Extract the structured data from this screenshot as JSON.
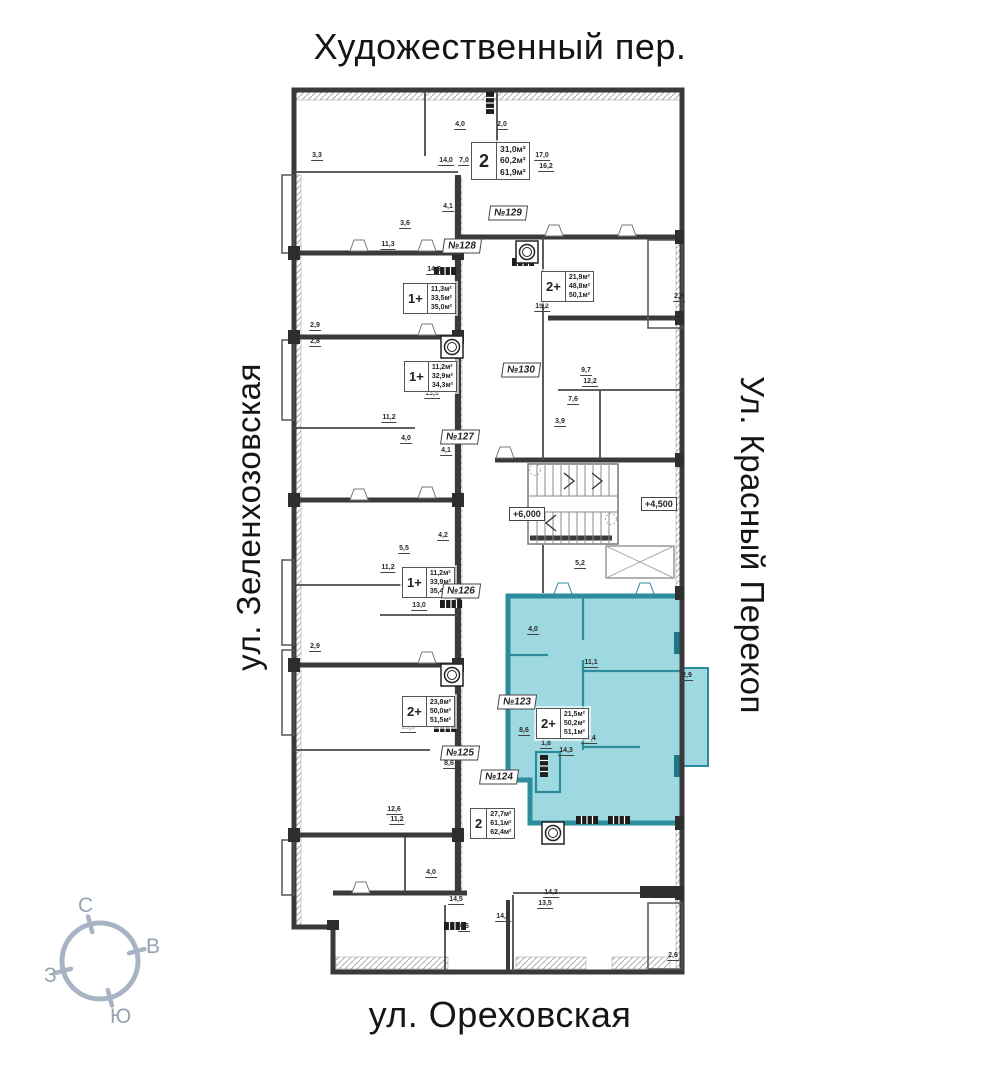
{
  "streets": {
    "top": "Художественный пер.",
    "left": "ул. Зеленхозовская",
    "right": "Ул. Красный Перекоп",
    "bottom": "ул. Ореховская"
  },
  "compass": {
    "north": "С",
    "east": "В",
    "west": "З",
    "south": "Ю"
  },
  "colors": {
    "highlight_fill": "#9ed8e1",
    "highlight_wall": "#2c8c9c",
    "wall": "#3a3a3a",
    "compass": "#a8b4c4"
  },
  "elevations": [
    {
      "label": "+6,000",
      "x": 509,
      "y": 507
    },
    {
      "label": "+4,500",
      "x": 641,
      "y": 497
    }
  ],
  "apartments": [
    {
      "number": "№129",
      "type": "2",
      "areas": [
        "31,0м²",
        "60,2м²",
        "61,9м²"
      ],
      "box": {
        "x": 471,
        "y": 142
      },
      "tag": {
        "x": 508,
        "y": 213
      },
      "large": true,
      "highlighted": false
    },
    {
      "number": "№128",
      "type": "1+",
      "areas": [
        "11,3м²",
        "33,5м²",
        "35,0м²"
      ],
      "box": {
        "x": 403,
        "y": 283
      },
      "tag": {
        "x": 462,
        "y": 246
      },
      "large": false,
      "highlighted": false
    },
    {
      "number": "№130",
      "type": "2+",
      "areas": [
        "21,9м²",
        "48,8м²",
        "50,1м²"
      ],
      "box": {
        "x": 541,
        "y": 271
      },
      "tag": {
        "x": 521,
        "y": 370
      },
      "large": false,
      "highlighted": false
    },
    {
      "number": "№127",
      "type": "1+",
      "areas": [
        "11,2м²",
        "32,9м²",
        "34,3м²"
      ],
      "box": {
        "x": 404,
        "y": 361
      },
      "tag": {
        "x": 460,
        "y": 437
      },
      "large": false,
      "highlighted": false
    },
    {
      "number": "№126",
      "type": "1+",
      "areas": [
        "11,2м²",
        "33,9м²",
        "35,4м²"
      ],
      "box": {
        "x": 402,
        "y": 567
      },
      "tag": {
        "x": 461,
        "y": 591
      },
      "large": false,
      "highlighted": false
    },
    {
      "number": "№125",
      "type": "2+",
      "areas": [
        "23,8м²",
        "50,0м²",
        "51,5м²"
      ],
      "box": {
        "x": 402,
        "y": 696
      },
      "tag": {
        "x": 460,
        "y": 753
      },
      "large": false,
      "highlighted": false
    },
    {
      "number": "№123",
      "type": "2+",
      "areas": [
        "21,5м²",
        "50,2м²",
        "51,1м²"
      ],
      "box": {
        "x": 536,
        "y": 708
      },
      "tag": {
        "x": 517,
        "y": 702
      },
      "large": false,
      "highlighted": true
    },
    {
      "number": "№124",
      "type": "2",
      "areas": [
        "27,7м²",
        "61,1м²",
        "62,4м²"
      ],
      "box": {
        "x": 470,
        "y": 808
      },
      "tag": {
        "x": 499,
        "y": 777
      },
      "large": false,
      "highlighted": false
    }
  ],
  "dimensions": [
    {
      "t": "3,3",
      "x": 317,
      "y": 161
    },
    {
      "t": "4,0",
      "x": 460,
      "y": 130
    },
    {
      "t": "2,0",
      "x": 502,
      "y": 130
    },
    {
      "t": "17,0",
      "x": 542,
      "y": 161
    },
    {
      "t": "14,0",
      "x": 446,
      "y": 166
    },
    {
      "t": "7,0",
      "x": 464,
      "y": 166
    },
    {
      "t": "16,2",
      "x": 546,
      "y": 172
    },
    {
      "t": "4,1",
      "x": 448,
      "y": 212
    },
    {
      "t": "3,6",
      "x": 405,
      "y": 229
    },
    {
      "t": "11,3",
      "x": 388,
      "y": 250
    },
    {
      "t": "14,5",
      "x": 434,
      "y": 275
    },
    {
      "t": "15,2",
      "x": 542,
      "y": 312
    },
    {
      "t": "2,9",
      "x": 315,
      "y": 331
    },
    {
      "t": "2,8",
      "x": 315,
      "y": 347
    },
    {
      "t": "2,6",
      "x": 679,
      "y": 302
    },
    {
      "t": "9,7",
      "x": 586,
      "y": 376
    },
    {
      "t": "12,2",
      "x": 590,
      "y": 387
    },
    {
      "t": "13,6",
      "x": 432,
      "y": 399
    },
    {
      "t": "7,6",
      "x": 573,
      "y": 405
    },
    {
      "t": "11,2",
      "x": 389,
      "y": 423
    },
    {
      "t": "3,9",
      "x": 560,
      "y": 427
    },
    {
      "t": "4,0",
      "x": 406,
      "y": 444
    },
    {
      "t": "4,1",
      "x": 446,
      "y": 456
    },
    {
      "t": "4,2",
      "x": 443,
      "y": 541
    },
    {
      "t": "5,5",
      "x": 404,
      "y": 554
    },
    {
      "t": "5,2",
      "x": 580,
      "y": 569
    },
    {
      "t": "11,2",
      "x": 388,
      "y": 573
    },
    {
      "t": "13,0",
      "x": 419,
      "y": 611
    },
    {
      "t": "4,0",
      "x": 533,
      "y": 635
    },
    {
      "t": "2,9",
      "x": 315,
      "y": 652
    },
    {
      "t": "11,1",
      "x": 591,
      "y": 668
    },
    {
      "t": "2,9",
      "x": 687,
      "y": 681
    },
    {
      "t": "13,6",
      "x": 408,
      "y": 733
    },
    {
      "t": "8,6",
      "x": 524,
      "y": 736
    },
    {
      "t": "10,4",
      "x": 589,
      "y": 744
    },
    {
      "t": "1,8",
      "x": 546,
      "y": 749
    },
    {
      "t": "14,3",
      "x": 566,
      "y": 756
    },
    {
      "t": "8,6",
      "x": 449,
      "y": 769
    },
    {
      "t": "12,6",
      "x": 394,
      "y": 815
    },
    {
      "t": "11,2",
      "x": 397,
      "y": 825
    },
    {
      "t": "4,0",
      "x": 431,
      "y": 878
    },
    {
      "t": "14,2",
      "x": 551,
      "y": 898
    },
    {
      "t": "14,5",
      "x": 456,
      "y": 905
    },
    {
      "t": "13,5",
      "x": 545,
      "y": 909
    },
    {
      "t": "14,7",
      "x": 503,
      "y": 922
    },
    {
      "t": "4,5",
      "x": 464,
      "y": 932
    },
    {
      "t": "2,6",
      "x": 673,
      "y": 961
    }
  ]
}
